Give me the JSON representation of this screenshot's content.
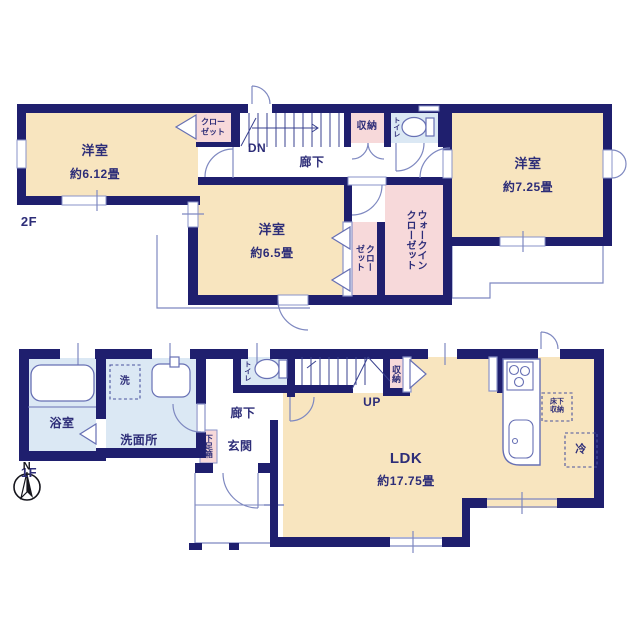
{
  "title": "2階建て住宅 間取り図",
  "colors": {
    "wall": "#1f1f6e",
    "room_cream": "#f8e5bf",
    "closet_pink": "#f7d9da",
    "wet_blue": "#dbe8f4",
    "thin_line": "#7e88c0",
    "fixture_line": "#6770b4",
    "text": "#2d2d78"
  },
  "floor2": {
    "label": "2F",
    "bedroom_612": {
      "name": "洋室",
      "size": "約6.12畳"
    },
    "bedroom_725": {
      "name": "洋室",
      "size": "約7.25畳"
    },
    "bedroom_65": {
      "name": "洋室",
      "size": "約6.5畳"
    },
    "closet_top": "クロー\nゼット",
    "closet_mid": "クロー\nゼット",
    "walk_in_closet": "ウォークイン\nクローゼット",
    "storage": "収納",
    "toilet": "トイレ",
    "hallway": "廊下",
    "stairs_down": "DN"
  },
  "floor1": {
    "label": "1F",
    "bath": "浴室",
    "washer": "洗",
    "washroom": "洗面所",
    "toilet": "トイレ",
    "hallway": "廊下",
    "entrance": "玄関",
    "shoe_box": "下足箱",
    "storage": "収納",
    "stairs_up": "UP",
    "ldk": {
      "name": "LDK",
      "size": "約17.75畳"
    },
    "underfloor_storage": "床下\n収納",
    "fridge": "冷"
  },
  "compass": {
    "north": "N"
  }
}
